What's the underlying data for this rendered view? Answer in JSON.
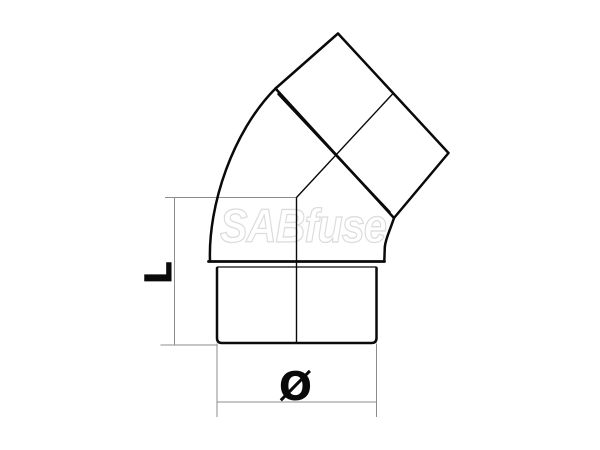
{
  "labels": {
    "length": "L",
    "diameter": "Ø"
  },
  "watermark": {
    "text": "SABfuse"
  },
  "colors": {
    "line": "#0a0a0a",
    "dimension": "#8c8c8c",
    "watermark_fill": "#ffffff",
    "watermark_outline": "#dcdcdc",
    "background": "#ffffff"
  }
}
